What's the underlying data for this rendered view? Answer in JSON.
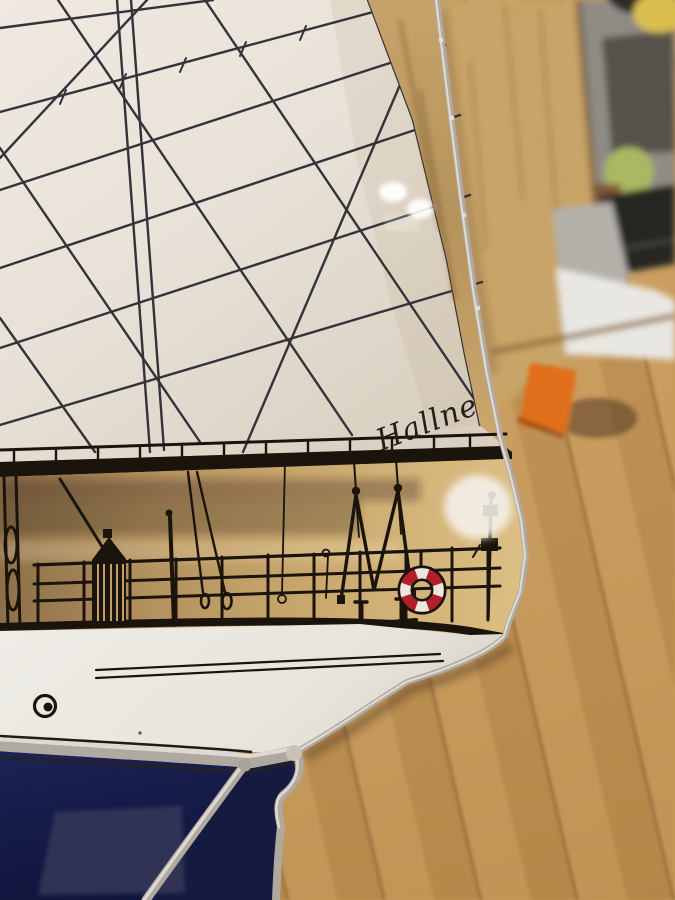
{
  "artwork": {
    "signature": "Hallne"
  },
  "colors": {
    "sail_white": "#e9e3d9",
    "sail_shadow": "#d9cfc1",
    "rigging_dark": "#34323a",
    "silhouette_black": "#1a140c",
    "band_amber": "#c2a066",
    "band_amber_dark": "#8d7048",
    "band_amber_light": "#dcbf84",
    "lifering_red": "#b1202a",
    "lifering_white": "#ece8e0",
    "hull_white": "#edebe4",
    "hull_shadow": "#dcd8cf",
    "sea_navy": "#1d2458",
    "sea_navy_deep": "#10153c",
    "sea_patch": "#303556",
    "solder_silver": "#b0a9a0",
    "solder_bright": "#ded9d2",
    "solder_dark": "#5f584e",
    "table_wood": "#c6985a",
    "plank_wood": "#c8a468",
    "clear_strip_wood": "#bfa06a",
    "gray_zone": "#8f8b85",
    "dark_band": "#56514a",
    "laptop_dark": "#262624",
    "paper_white": "#e9e7e2",
    "paper_shadow": "#b3b0aa",
    "green_ball": "#aab763",
    "yellow_object": "#d9bd50",
    "orange_block": "#e0701d"
  }
}
